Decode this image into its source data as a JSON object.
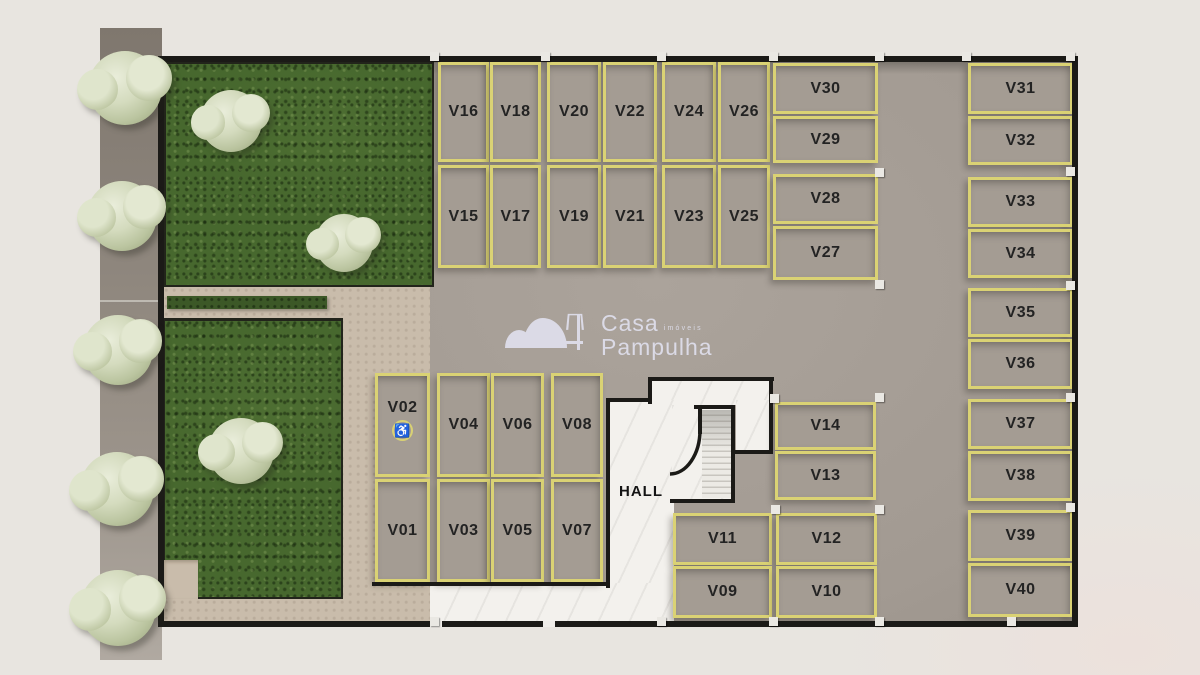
{
  "plan": {
    "hall_label": "HALL",
    "accessible_glyph": "♿",
    "logo": {
      "brand": "Casa",
      "brand_sub": "imóveis",
      "brand2": "Pampulha"
    },
    "colors": {
      "stall_border": "#dad274",
      "asphalt": "#a29a92",
      "lawn": "#47682e",
      "wall": "#1b1a17",
      "walkway_white": "#f3f1ed",
      "path_tan": "#c9bcab",
      "logo": "#dbdae6"
    },
    "stalls": [
      {
        "id": "V16",
        "x": 438,
        "y": 62,
        "w": 51,
        "h": 100
      },
      {
        "id": "V18",
        "x": 490,
        "y": 62,
        "w": 51,
        "h": 100
      },
      {
        "id": "V15",
        "x": 438,
        "y": 165,
        "w": 51,
        "h": 103
      },
      {
        "id": "V17",
        "x": 490,
        "y": 165,
        "w": 51,
        "h": 103
      },
      {
        "id": "V20",
        "x": 547,
        "y": 62,
        "w": 54,
        "h": 100
      },
      {
        "id": "V22",
        "x": 603,
        "y": 62,
        "w": 54,
        "h": 100
      },
      {
        "id": "V19",
        "x": 547,
        "y": 165,
        "w": 54,
        "h": 103
      },
      {
        "id": "V21",
        "x": 603,
        "y": 165,
        "w": 54,
        "h": 103
      },
      {
        "id": "V24",
        "x": 662,
        "y": 62,
        "w": 54,
        "h": 100
      },
      {
        "id": "V26",
        "x": 718,
        "y": 62,
        "w": 52,
        "h": 100
      },
      {
        "id": "V23",
        "x": 662,
        "y": 165,
        "w": 54,
        "h": 103
      },
      {
        "id": "V25",
        "x": 718,
        "y": 165,
        "w": 52,
        "h": 103
      },
      {
        "id": "V30",
        "x": 773,
        "y": 63,
        "w": 105,
        "h": 51
      },
      {
        "id": "V29",
        "x": 773,
        "y": 116,
        "w": 105,
        "h": 47
      },
      {
        "id": "V28",
        "x": 773,
        "y": 174,
        "w": 105,
        "h": 50
      },
      {
        "id": "V27",
        "x": 773,
        "y": 226,
        "w": 105,
        "h": 54
      },
      {
        "id": "V31",
        "x": 968,
        "y": 63,
        "w": 105,
        "h": 51
      },
      {
        "id": "V32",
        "x": 968,
        "y": 116,
        "w": 105,
        "h": 49
      },
      {
        "id": "V33",
        "x": 968,
        "y": 177,
        "w": 105,
        "h": 50
      },
      {
        "id": "V34",
        "x": 968,
        "y": 229,
        "w": 105,
        "h": 49
      },
      {
        "id": "V35",
        "x": 968,
        "y": 288,
        "w": 105,
        "h": 49
      },
      {
        "id": "V36",
        "x": 968,
        "y": 339,
        "w": 105,
        "h": 50
      },
      {
        "id": "V37",
        "x": 968,
        "y": 399,
        "w": 105,
        "h": 50
      },
      {
        "id": "V38",
        "x": 968,
        "y": 451,
        "w": 105,
        "h": 50
      },
      {
        "id": "V39",
        "x": 968,
        "y": 510,
        "w": 105,
        "h": 51
      },
      {
        "id": "V40",
        "x": 968,
        "y": 563,
        "w": 105,
        "h": 54
      },
      {
        "id": "V02",
        "x": 375,
        "y": 373,
        "w": 55,
        "h": 104,
        "accessible": true
      },
      {
        "id": "V04",
        "x": 437,
        "y": 373,
        "w": 53,
        "h": 104
      },
      {
        "id": "V06",
        "x": 491,
        "y": 373,
        "w": 53,
        "h": 104
      },
      {
        "id": "V08",
        "x": 551,
        "y": 373,
        "w": 52,
        "h": 104
      },
      {
        "id": "V01",
        "x": 375,
        "y": 479,
        "w": 55,
        "h": 103
      },
      {
        "id": "V03",
        "x": 437,
        "y": 479,
        "w": 53,
        "h": 103
      },
      {
        "id": "V05",
        "x": 491,
        "y": 479,
        "w": 53,
        "h": 103
      },
      {
        "id": "V07",
        "x": 551,
        "y": 479,
        "w": 52,
        "h": 103
      },
      {
        "id": "V14",
        "x": 775,
        "y": 402,
        "w": 101,
        "h": 48
      },
      {
        "id": "V13",
        "x": 775,
        "y": 451,
        "w": 101,
        "h": 49
      },
      {
        "id": "V11",
        "x": 673,
        "y": 513,
        "w": 99,
        "h": 52
      },
      {
        "id": "V12",
        "x": 776,
        "y": 513,
        "w": 101,
        "h": 52
      },
      {
        "id": "V09",
        "x": 673,
        "y": 566,
        "w": 99,
        "h": 52
      },
      {
        "id": "V10",
        "x": 776,
        "y": 566,
        "w": 101,
        "h": 52
      }
    ]
  }
}
